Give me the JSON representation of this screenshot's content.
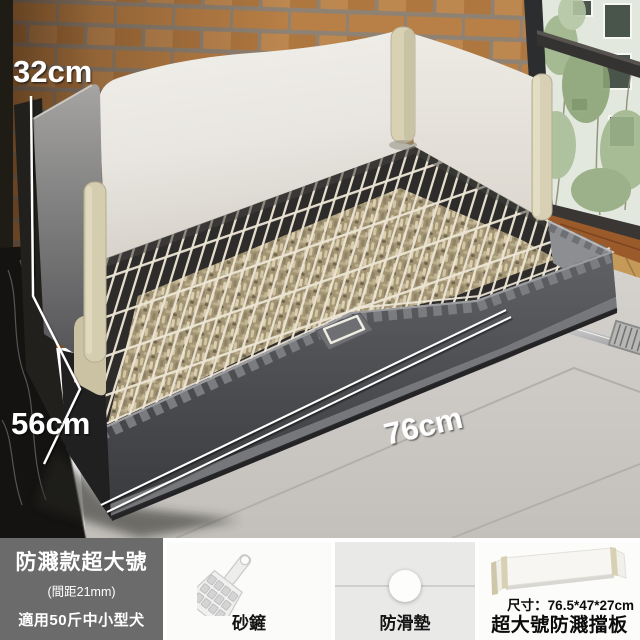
{
  "scene": {
    "height_label": "32cm",
    "depth_label": "56cm",
    "width_label": "76cm"
  },
  "spec_badge": {
    "title": "防濺款超大號",
    "pitch": "(間距21mm)",
    "suit": "適用50斤中小型犬"
  },
  "accessories": {
    "scoop_label": "砂鏟",
    "pad_label": "防滑墊"
  },
  "baffle": {
    "size": "尺寸：76.5*47*27cm",
    "name": "超大號防濺擋板"
  },
  "colors": {
    "brick": "#b5783f",
    "panel_white": "#ebe8e3",
    "post_beige": "#d8d1b4",
    "tray_gray": "#4a4b4e",
    "pellet_tan": "#b3a685",
    "badge_gray": "#6b6b6b"
  }
}
